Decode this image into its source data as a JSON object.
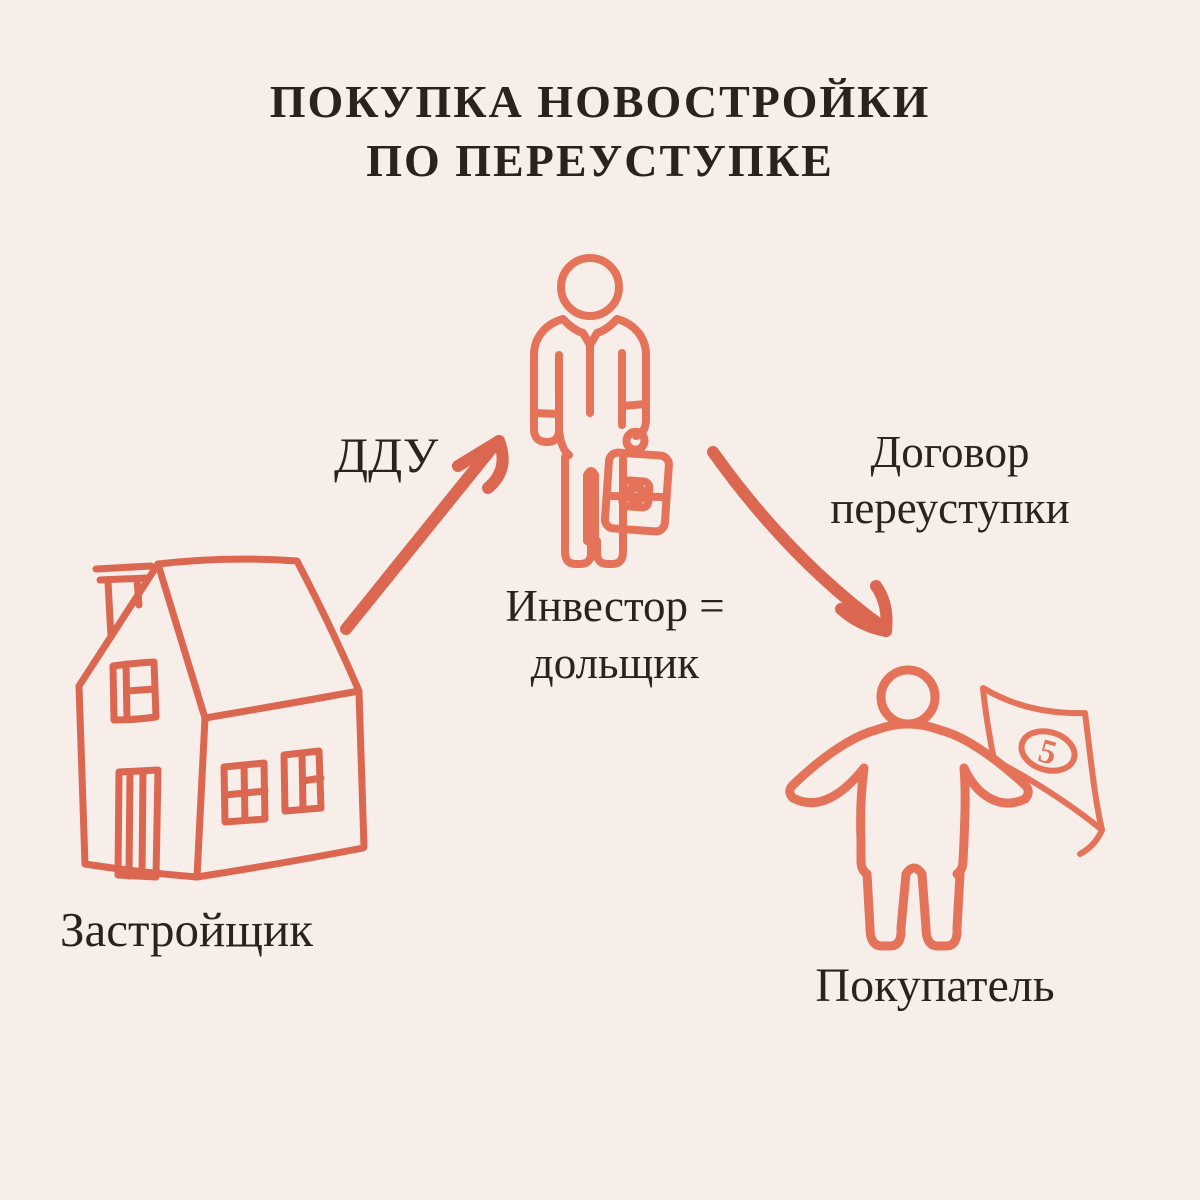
{
  "title": {
    "line1": "ПОКУПКА НОВОСТРОЙКИ",
    "line2": "ПО ПЕРЕУСТУПКЕ"
  },
  "nodes": {
    "developer": {
      "label": "Застройщик",
      "icon": "house-icon"
    },
    "investor": {
      "label_line1": "Инвестор =",
      "label_line2": "дольщик",
      "icon": "businessman-briefcase-icon"
    },
    "buyer": {
      "label": "Покупатель",
      "icon": "person-money-flag-icon",
      "banknote_value": "5"
    }
  },
  "edges": {
    "ddu": {
      "label": "ДДУ"
    },
    "assignment": {
      "label_line1": "Договор",
      "label_line2": "переуступки"
    }
  },
  "colors": {
    "background": "#f7ede9",
    "ink": "#2b221c",
    "coral": "#dc6750",
    "coral_light": "#e5735a"
  }
}
